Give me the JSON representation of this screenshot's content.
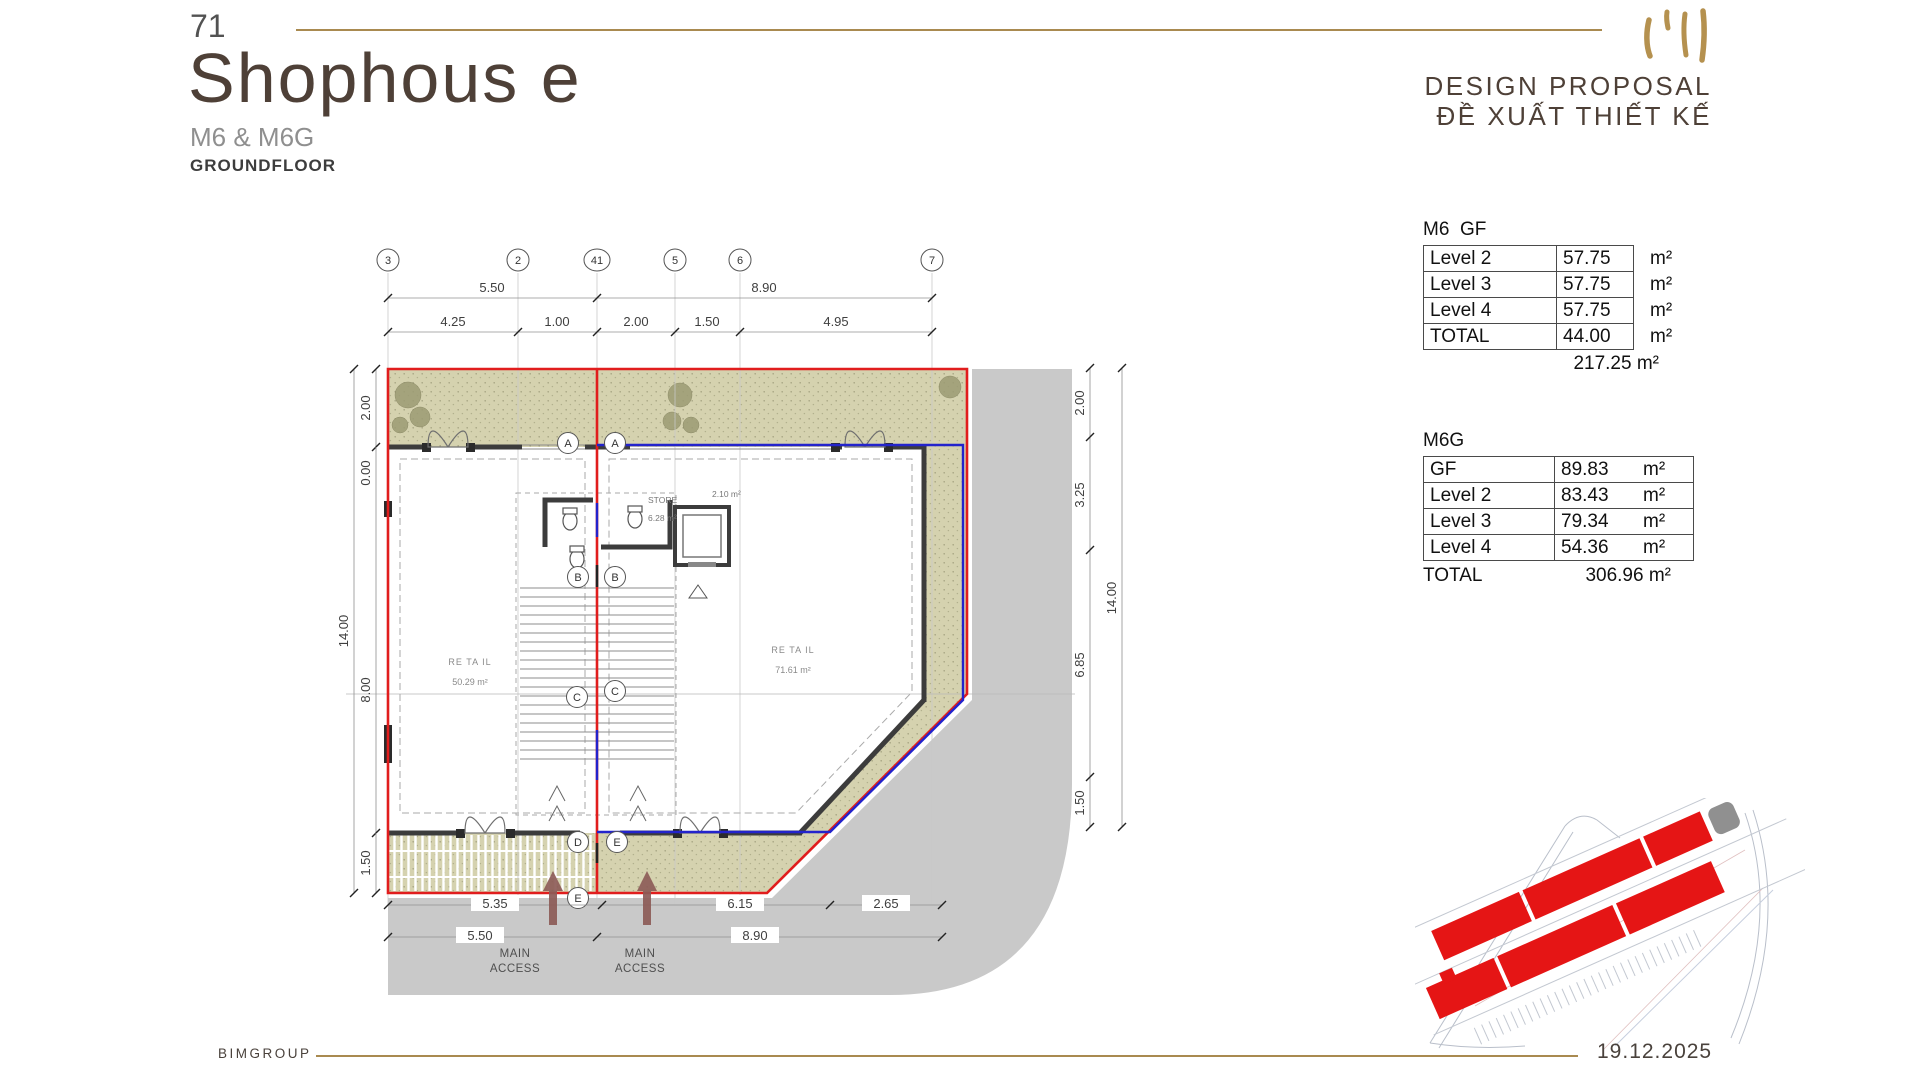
{
  "header": {
    "page_number": "71",
    "title": "Shophous e",
    "subtitle": "M6 & M6G",
    "floor": "GROUNDFLOOR",
    "proposal_en": "DESIGN PROPOSAL",
    "proposal_vi": "ĐỀ XUẤT THIẾT KẾ"
  },
  "footer": {
    "company": "BIMGROUP",
    "date": "19.12.2025"
  },
  "tables": {
    "m6": {
      "title": "M6  GF",
      "rows": [
        {
          "label": "Level 2",
          "value": "57.75",
          "unit": "m²"
        },
        {
          "label": "Level 3",
          "value": "57.75",
          "unit": "m²"
        },
        {
          "label": "Level 4",
          "value": "57.75",
          "unit": "m²"
        },
        {
          "label": "TOTAL",
          "value": "44.00",
          "unit": "m²"
        }
      ],
      "grand_total": "217.25 m²"
    },
    "m6g": {
      "title": "M6G",
      "rows": [
        {
          "label": "GF",
          "value": "89.83",
          "unit": "m²"
        },
        {
          "label": "Level 2",
          "value": "83.43",
          "unit": "m²"
        },
        {
          "label": "Level 3",
          "value": "79.34",
          "unit": "m²"
        },
        {
          "label": "Level 4",
          "value": "54.36",
          "unit": "m²"
        }
      ],
      "total_label": "TOTAL",
      "total_value": "306.96 m²"
    }
  },
  "plan": {
    "grid": [
      "3",
      "2",
      "41",
      "5",
      "6",
      "7"
    ],
    "sections": [
      "A",
      "A",
      "B",
      "B",
      "C",
      "C",
      "D",
      "E",
      "E"
    ],
    "dims": {
      "top1": [
        "5.50",
        "8.90"
      ],
      "top2": [
        "4.25",
        "1.00",
        "2.00",
        "1.50",
        "4.95"
      ],
      "left": [
        "2.00",
        "0.00",
        "14.00",
        "8.00",
        "1.50"
      ],
      "right": [
        "2.00",
        "3.25",
        "14.00",
        "6.85",
        "1.50"
      ],
      "bottom1": [
        "5.35",
        "6.15",
        "2.65"
      ],
      "bottom2": [
        "5.50",
        "8.90"
      ]
    },
    "rooms": {
      "retail_left": {
        "name": "RE TA IL",
        "area": "50.29 m²"
      },
      "retail_right": {
        "name": "RE TA IL",
        "area": "71.61 m²"
      },
      "store": {
        "name": "STORE",
        "area": "6.28 m²"
      },
      "wc": {
        "area": "2.10 m²"
      }
    },
    "access": {
      "line1": "MAIN",
      "line2": "ACCESS"
    }
  },
  "colors": {
    "accent_gold": "#a98a50",
    "boundary_red": "#e11d1d",
    "boundary_blue": "#2323cc",
    "landscape_green": "#d5d2af",
    "road_gray": "#c9c9c9",
    "site_building_red": "#e51515"
  }
}
